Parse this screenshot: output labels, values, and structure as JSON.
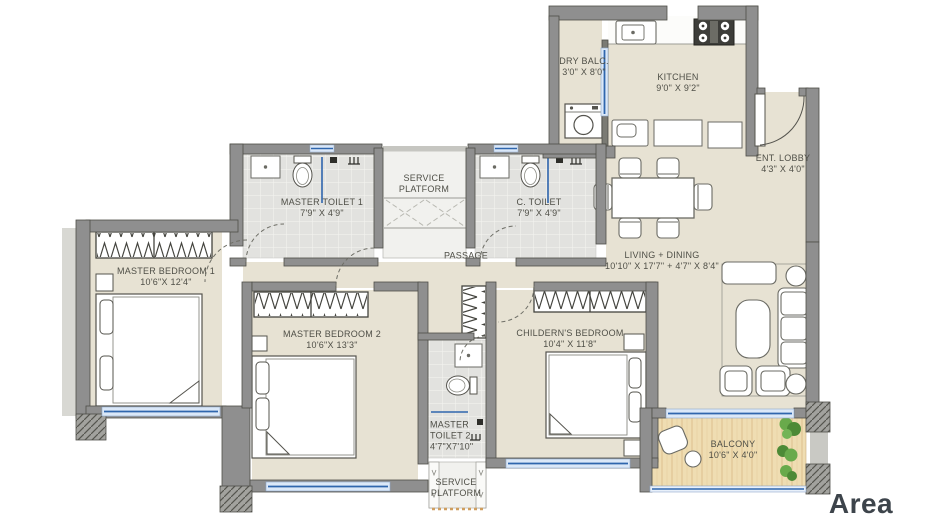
{
  "floor_plan": {
    "rooms": {
      "dry_balcony": {
        "name": "DRY BALC.",
        "dims": "3'0\" X 8'0\""
      },
      "kitchen": {
        "name": "KITCHEN",
        "dims": "9'0\" X 9'2\""
      },
      "ent_lobby": {
        "name": "ENT. LOBBY",
        "dims": "4'3\" X 4'0\""
      },
      "master_toilet_1": {
        "name": "MASTER TOILET 1",
        "dims": "7'9\" X 4'9\""
      },
      "service_platform_top": {
        "line1": "SERVICE",
        "line2": "PLATFORM"
      },
      "c_toilet": {
        "name": "C. TOILET",
        "dims": "7'9\" X 4'9\""
      },
      "passage": {
        "name": "PASSAGE"
      },
      "living_dining": {
        "name": "LIVING + DINING",
        "dims": "10'10\" X 17'7\" + 4'7\" X 8'4\""
      },
      "master_bedroom_1": {
        "name": "MASTER BEDROOM 1",
        "dims": "10'6\"X 12'4\""
      },
      "master_bedroom_2": {
        "name": "MASTER BEDROOM 2",
        "dims": "10'6\"X 13'3\""
      },
      "childrens_bedroom": {
        "name": "CHILDERN'S BEDROOM",
        "dims": "10'4\" X 11'8\""
      },
      "master_toilet_2": {
        "line1": "MASTER",
        "line2": "TOILET 2",
        "line3": "4'7\"X7'10\""
      },
      "service_platform_bottom": {
        "line1": "SERVICE",
        "line2": "PLATFORM"
      },
      "balcony": {
        "name": "BALCONY",
        "dims": "10'6\" X 4'0\""
      }
    },
    "footer": {
      "area_label": "Area"
    },
    "colors": {
      "wall": "#8f8f8f",
      "wall_edge": "#4e4e48",
      "floor": "#e7e2d3",
      "tile": "#e2e2df",
      "wood": "#efddb2",
      "window_blue": "#2f66ad",
      "window_light": "#dbe8f8",
      "text": "#4f4f47",
      "area_text": "#3d444b",
      "plant_green": "#5f9e41"
    },
    "furniture_symbols": [
      "washing-machine",
      "kitchen-sink",
      "hob",
      "dining-table",
      "sofa-set",
      "double-bed",
      "wardrobe",
      "wc",
      "shower",
      "balcony-chair",
      "plants"
    ]
  }
}
